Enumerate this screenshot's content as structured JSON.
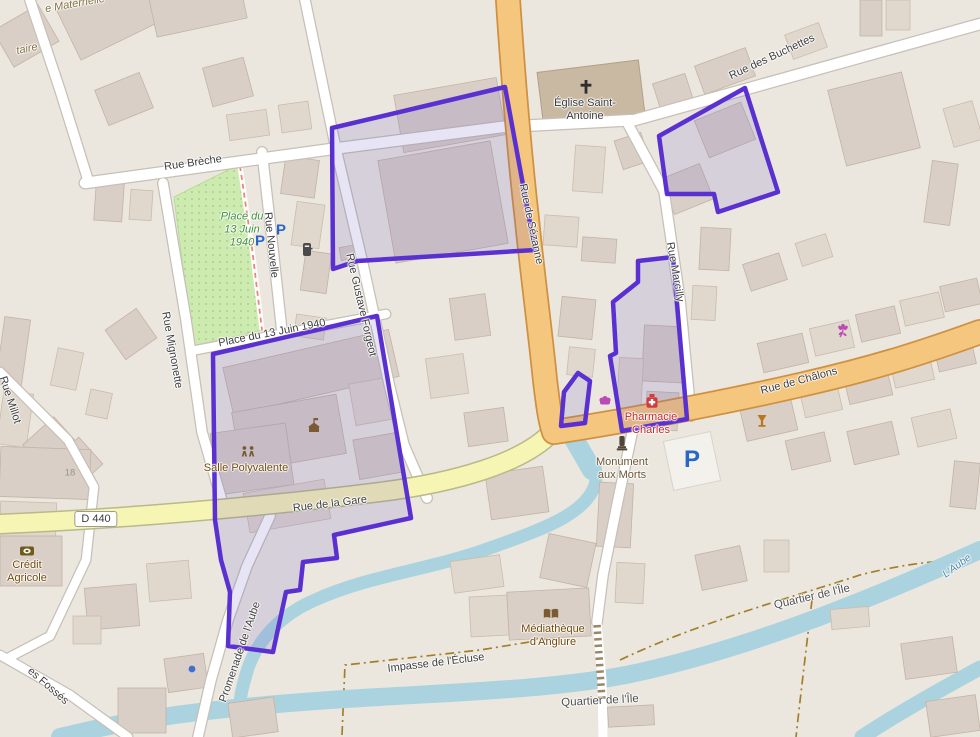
{
  "streets": {
    "breche": "Rue Brèche",
    "nouvelle": "Rue Nouvelle",
    "mignonette": "Rue Mignonette",
    "gustave_forgeot": "Rue Gustave Forgeot",
    "sezanne": "Rue de Sézanne",
    "marcilly": "Rue Marcilly",
    "buchettes": "Rue des Buchettes",
    "chalons": "Rue de Châlons",
    "gare": "Rue de la Gare",
    "place_13_juin": "Place du 13 Juin 1940",
    "promenade_aube": "Promenade de l'Aube",
    "impasse_ecluse": "Impasse de l'Écluse",
    "millot": "Rue Millot",
    "fosses_partial": "es Fossés",
    "d440": "D 440"
  },
  "places": {
    "quartier_ile": "Quartier de l'Île",
    "aube_river": "L'Aube",
    "park_line1": "Place du",
    "park_line2": "13 Juin",
    "park_line3": "1940"
  },
  "pois": {
    "eglise_l1": "Église Saint-",
    "eglise_l2": "Antoine",
    "pharmacie_l1": "Pharmacie",
    "pharmacie_l2": "Charles",
    "monument_l1": "Monument",
    "monument_l2": "aux Morts",
    "salle_polyvalente": "Salle Polyvalente",
    "mediatheque_l1": "Médiathèque",
    "mediatheque_l2": "d'Anglure",
    "credit_l1": "Crédit",
    "credit_l2": "Agricole",
    "maternelle_partial": "e Maternelle",
    "elementaire_partial": "taire",
    "house_18": "18",
    "parking": "P"
  },
  "icons": {
    "church": "latin-cross",
    "pharmacy": "medicine-bottle-with-cross",
    "bakery": "bread-shop",
    "monument": "war-memorial",
    "community_centre": "two-people",
    "town_hall": "civic-building-with-flag",
    "bank": "coin",
    "library": "open-book",
    "bar": "wine-glass",
    "florist": "flower",
    "postbox": "letter-box",
    "parking": "P",
    "poi_dot": "blue-dot"
  },
  "colors": {
    "selection_purple": "#5a31d0",
    "water": "#aad3df",
    "park_green": "#cdebb0",
    "road_primary_orange": "#f5c67e",
    "road_tertiary_yellow": "#f7f5b4",
    "amenity_brown": "#734a08",
    "health_red": "#c22727",
    "shop_magenta": "#bb4ab4",
    "parking_blue": "#2a66c8",
    "background": "#ebe7df"
  }
}
